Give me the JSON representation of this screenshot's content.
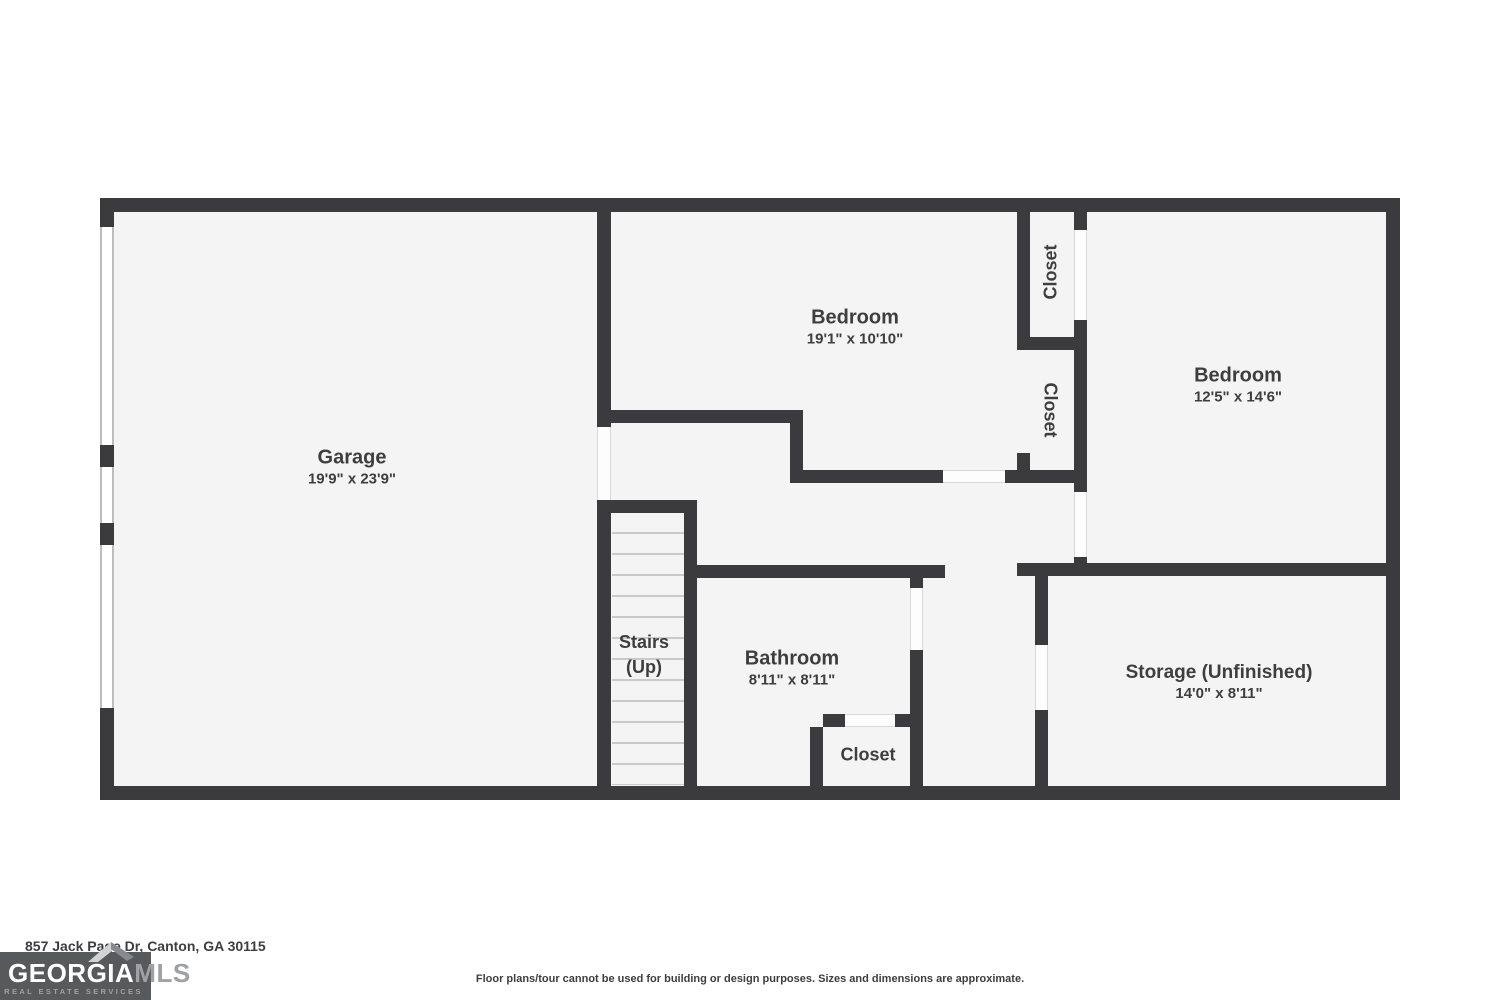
{
  "rooms": {
    "garage": {
      "name": "Garage",
      "dims": "19'9\" x 23'9\""
    },
    "bedroom1": {
      "name": "Bedroom",
      "dims": "19'1\" x 10'10\""
    },
    "bedroom2": {
      "name": "Bedroom",
      "dims": "12'5\" x 14'6\""
    },
    "bathroom": {
      "name": "Bathroom",
      "dims": "8'11\" x 8'11\""
    },
    "storage": {
      "name": "Storage (Unfinished)",
      "dims": "14'0\" x 8'11\""
    },
    "closet_top": {
      "name": "Closet"
    },
    "closet_mid": {
      "name": "Closet"
    },
    "closet_bath": {
      "name": "Closet"
    },
    "stairs": {
      "line1": "Stairs",
      "line2": "(Up)"
    }
  },
  "footer": {
    "address": "857 Jack Page Dr, Canton, GA 30115",
    "disclaimer": "Floor plans/tour cannot be used for building or design purposes. Sizes and dimensions are approximate."
  },
  "logo": {
    "brand_primary": "GEORGIA",
    "brand_secondary": "MLS",
    "tagline": "REAL ESTATE SERVICES"
  },
  "colors": {
    "wall": "#3b3b3d",
    "floor": "#f4f4f4",
    "label_text": "#3e3e40",
    "stair_tread": "#c9c9c9",
    "logo_background": "#58595b",
    "logo_gray": "#9fa1a4"
  }
}
